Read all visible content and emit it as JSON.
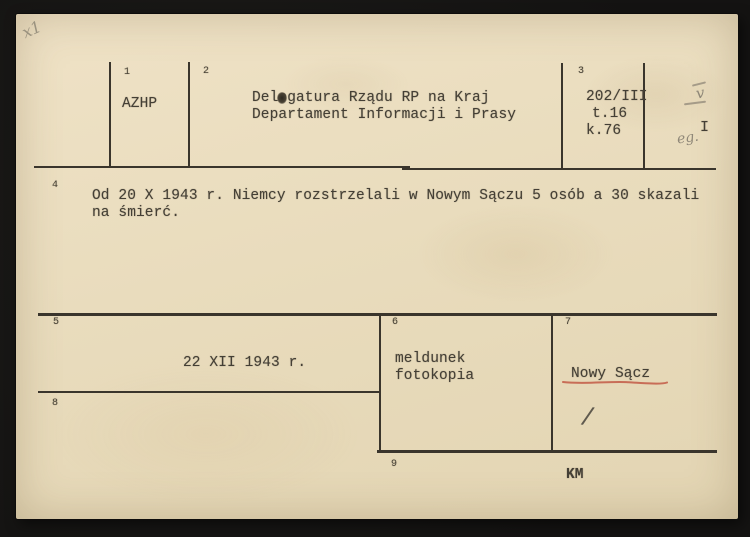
{
  "card": {
    "fields": {
      "f1": {
        "label": "1",
        "value": "AZHP"
      },
      "f2": {
        "label": "2",
        "line1": "Delegatura Rządu RP na Kraj",
        "line2": "Departament Informacji i Prasy"
      },
      "f3": {
        "label": "3",
        "line1": "202/III",
        "line2": "t.16",
        "line3": "k.76"
      },
      "f4": {
        "label": "4",
        "line1": "Od 20 X 1943 r. Niemcy rozstrzelali w Nowym Sączu 5 osób a 30 skazali",
        "line2": "na śmierć."
      },
      "f5": {
        "label": "5",
        "value": "22 XII 1943 r."
      },
      "f6": {
        "label": "6",
        "line1": "meldunek",
        "line2": "fotokopia"
      },
      "f7": {
        "label": "7",
        "value": "Nowy Sącz"
      },
      "f8": {
        "label": "8",
        "value": ""
      },
      "f9": {
        "label": "9",
        "value": "KM"
      }
    },
    "annotations": {
      "corner_mark": "x1",
      "check_mark": "v",
      "copy_numeral": "I",
      "pencil_note": "eg.",
      "slash_mark": "/"
    },
    "colors": {
      "paper": "#e9dcbd",
      "ink": "#443f35",
      "rule": "#3a352c",
      "red_underline": "#c0523f",
      "pencil": "#8f8778",
      "backdrop": "#151412"
    }
  }
}
